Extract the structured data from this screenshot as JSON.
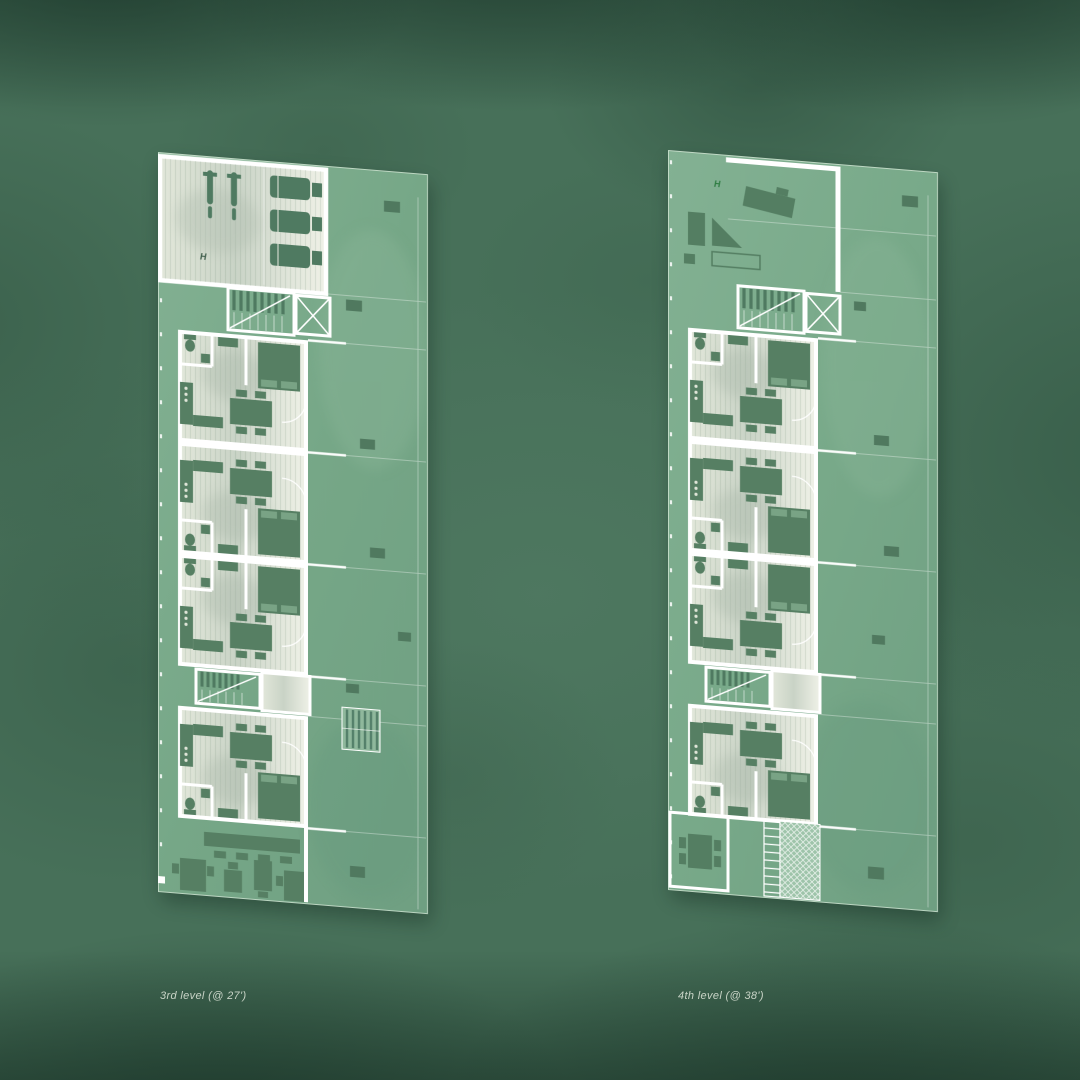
{
  "plans": [
    {
      "id": "level-3",
      "label": "3rd level (@ 27')",
      "helipad_marker": "H"
    },
    {
      "id": "level-4",
      "label": "4th level (@ 38')",
      "helipad_marker": "H"
    }
  ],
  "palette": {
    "background_green": "#477059",
    "background_dark": "#2e5243",
    "deck_green": "#76a787",
    "paper_interior": "#dfe5d8",
    "wall_white": "#ffffff",
    "furniture_green": "#567f63",
    "marker_level3": "#3f5d4b",
    "marker_level4": "#2f7d43",
    "caption_text": "#c9d4c7"
  }
}
